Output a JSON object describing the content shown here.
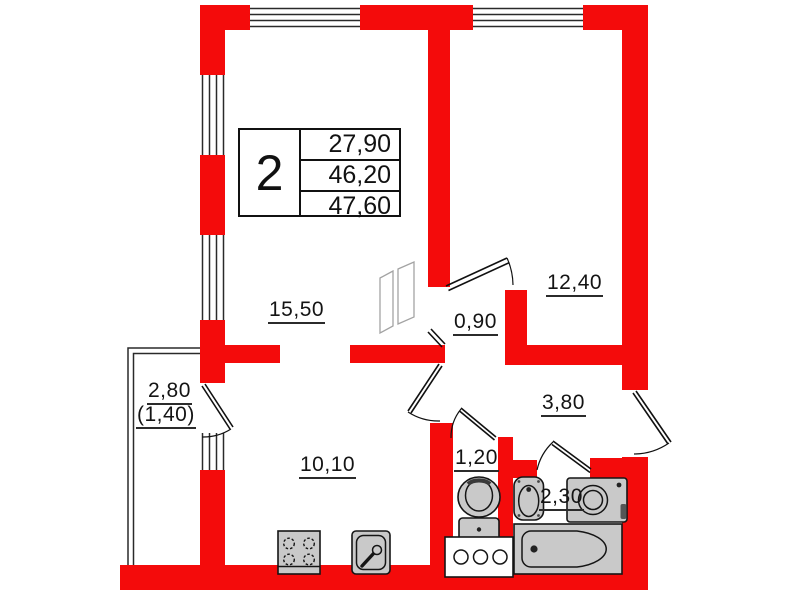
{
  "plan": {
    "kind": "apartment-floor-plan",
    "stamp": {
      "rooms_count": "2",
      "living_area": "27,90",
      "area": "46,20",
      "total_area": "47,60"
    },
    "rooms": {
      "living": {
        "area": "15,50"
      },
      "bedroom": {
        "area": "12,40"
      },
      "hall": {
        "area": "0,90"
      },
      "corridor": {
        "area": "3,80"
      },
      "wc": {
        "area": "1,20"
      },
      "bathroom": {
        "area": "2,30"
      },
      "kitchen": {
        "area": "10,10"
      },
      "balcony": {
        "area": "2,80",
        "reduced_area": "(1,40)"
      }
    },
    "fixtures": [
      "stove-icon",
      "kitchen-sink-icon",
      "toilet-icon",
      "cabinet-icon",
      "washbasin-icon",
      "washing-machine-icon",
      "bathtub-icon",
      "folding-door-icon"
    ],
    "colors": {
      "wall": "#f40b0b",
      "fixture_fill": "#c9c9c9",
      "line": "#1a1a1a"
    }
  }
}
